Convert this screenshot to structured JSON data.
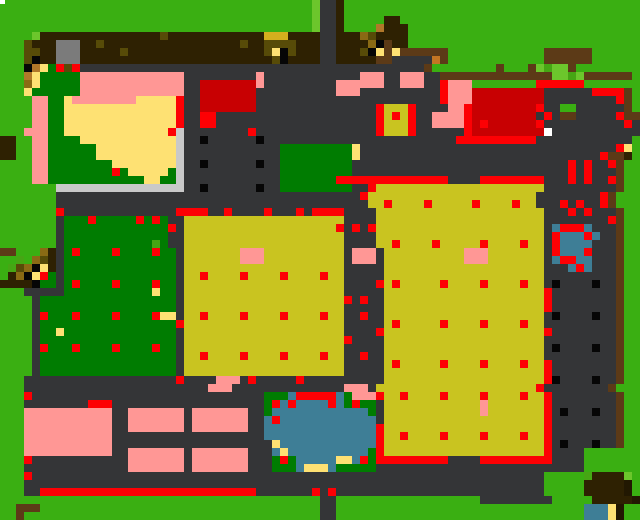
{
  "map": {
    "type": "pixel-tile-map",
    "subject": "top-down pixel farm map",
    "width_px": 640,
    "height_px": 520,
    "tile_size": 8,
    "columns": 80,
    "rows": 65,
    "palette": {
      "G": "#3aaf12",
      "L": "#6cc62c",
      "M": "#46a614",
      "T": "#007c01",
      "Y": "#c9c420",
      "O": "#d4af1e",
      "y": "#fee173",
      "P": "#ff9795",
      "R": "#fd0004",
      "D": "#c80002",
      "N": "#2e2102",
      "S": "#5c3a17",
      "o": "#8a6a14",
      "d": "#574b08",
      "K": "#060606",
      "A": "#343537",
      "l": "#c9c9c9",
      "g": "#7b7b7b",
      "t": "#3e7e96",
      "n": "#b1782a",
      "x": "#c37523",
      "w": "#ffffff",
      "B": "#221802"
    },
    "palette_legend": {
      "G": "grass",
      "L": "light-grass",
      "M": "shrub-green",
      "T": "dark-green-field",
      "Y": "yellow-crop-field",
      "O": "gold-block",
      "y": "pale-yellow-path",
      "P": "pink-building",
      "R": "red-marker",
      "D": "dark-red-building",
      "N": "dark-brown-soil",
      "S": "wood-brown",
      "o": "light-wood",
      "d": "dark-olive-wood",
      "K": "black-dot",
      "A": "dark-path",
      "l": "light-stone",
      "g": "gray-stone",
      "t": "water",
      "n": "tan-wood",
      "x": "orange-block",
      "w": "white-tile",
      "B": "dark-corner"
    },
    "pixel_rows": [
      "GGGGGGGGGGGGGGGGGGGGGGGGGGGGGGGGGGGGGGGLAANGGGGGGGGGGGGGGGGGGGGGGGGGGGGGGGGGGGG",
      "GGGGGGGGGGGGGGGGGGGGGGGGGGGGGGGGGGGGGGGLAANGGGGGGGGGGGGGGGGGGGGGGGGGGGGGGGGGGGG",
      "GGGGGGGGGGGGGGGGGGGGGGGGGGGGGGGGGGGGGGGLAANGGGGGNNGGGGGGGGGGGGGGGGGGGGGGGGGGGGGG",
      "GGGGGGGGGGGGGGGGGGGGGGGGGGGGGGGGGGGGGGGLAANGGGGnNNNGGGGGGGGGGGGGGGGGGGGGGGGGGGGG",
      "GGGGLNNNNNNNNNNNNNNNdNNNNNNNNNNNNOOONNNNAANNNodNNNNGGGGGGGGGGGGGGGGGGGGGGGGGGGGG",
      "GGGdNNNgggNNdNNNNNNNNNNNNNNNNNdNNddddNNNAANNNNoKSNNGGGGGGGGGGGGGGGGGGGGGGGGGGGGG",
      "GGGddNNgggNNNNNdNNNNNNNNNNNNNNNNNdyKdNNNAANNNdKySySSSSSSGGGGGGGGGGGGSSSSSSGGGGGG",
      "GGGdKNNgggNNNNNNNNNNNNNNNNNNNNNNNNdKNNNNAANNNNNSSAAAAAxSGGGGGGGGGGGGSSSSSSGGGGGG",
      "GGGKnyTRdRAAAAAAAAAAAAAAAAAAAAAAAAAAAAAAAAAAAAAAAAAAASGGGGGGGGSGGGSLMLLSGGGGGG",
      "GGGnyTTTTTPPPPPPPPPPPPPAAAAAAAAAPAAAAAAAAAAAAPPPAAPPPAASSSSSSSSSSSSSSLLMLSSSSSSG",
      "GGGoyTTTTTPPPPPPPPPPPPPAADDDDDDDPAAAAAAAAAPPPPPPAAPPPAARPPPGGGGGGGGRRRRRRGGGGGGG",
      "GGGyTTTTTTPPPPPPPPPPPPPAADDDDDDDAAAAAAAAAAPPPAAAAAAAAAARPPPDDDDDDDDDAAAAAARRRRSG",
      "GGGGPPTTyPPPPPPPPyyyyyRAADDDDDDDAAAAAAAAAAAAAAAAAAAAAAARPPPDDDDDDDDDAAAAAAAAARSG",
      "GGGGPPTTyyyyyyyyyyyyyyRAADDDDDDDAAAAAAAAAAAAAAARYYYRAAAAPPRDDDDDDDDRAAGGAAAAAASG",
      "GGGGPPTTyyyyyyyyyyyyyyRAARRAAAAAAAAAAAAAAAAAAAARYRYRAAPPPPRDDDDDDDDARASSAAAAARSS",
      "GGGGPPTTyyyyyyyyyyyyyyRAARRAAAAAAAAAAAAAAAAAAAARYYYRAAPPPPRDRDDDDDDRAAAAAAAAAARA",
      "GGGPPPTTyyyyyyyyyyyyyRlAAAAAAAARAAAAAAAAAAAAAAARYYYRAAAAAARDDDDDDDDDwAAAAAAAAAAA",
      "NNGGPPTTTTyyyyyyyyyyyylAAKAAAAAAKAAAAAAAAAAAAAAAAAAAAAAAARRRRRRRRRRAAAAAAAAAAAA",
      "NNGGPPTTTTTTyyyyyyyyyylAAAAAAAAAAAATTTTTTTTTyAAAAAAAAAAAAAAAAAAAAAAAAAAAAAAAARy",
      "NNGGPPTTTTTTyyyyyyyyyylAAAAAAAAAAAATTTTTTTTTyAAAAAAAAAAAAAAAAAAAAAAAAAAAAAARSSN",
      "GGGGPPTTTTTTTTyyyyyyyylAAKAAAAAAKAATTTTTTTTTAAAAAAAAAAAAAAAAAAAAAAAAAAARARAARSGG",
      "GGGGPPTTTTTTTTRTyyyyyTlAAAAAAAAAAAATTTTTTTTTAAAAAAAAAAAAAAAAAAAAAAAAAAARARAAASGG",
      "GGGGPPTTTTTTTTTTTTyyTTlAAAAAAAAAAAATTTTTTTRRRRRRRRRRRRRRAAAARRRRRRRRAAARARAARSGG",
      "GGGGGGGllllllllllllllllAAKAAAAAAKAATTTTTTTTTAARYYYYYYYYYYYYYYYYYYYYYAAAAAAAAASGG",
      "GGGGGGGAAAAAAAAAAAAAAAAAAAAAAAAAAAAAAAAAAAAAARYYYYYYYYYYYYYYYYYYYYYAAAAAAAARSGG",
      "GGGGGGGAAAAAAAAAAAAAAAAAAAAAAAAAAAAAAAAAAAAAAAYYRYYYYRYYYYYRYYYYRYYAAARARAARSGG",
      "GGGGGGGRAAAAAAAAAAAAAARRRRAARAAAARAAARARRRRAAAAYYYYYYYYYYYYYYYYYYYYYAAARARAAASGG",
      "GGGGGGGATTTRTTTTTRTRTAAYYYYYYYYYYYYYYYYYYYYAAAAYYYYYYYYYYYYYYYYYYYYYAAAAAAAARSGG",
      "GGGGGGGATTTTTTTTTTTTTRAYYYYYYYYYYYYYYYYYYYRARARYYYYYYYYYYYYYYYYYYYYYAtRRRtAAASGG",
      "GGGGGGGATTTTTTTTTTTTTAAYYYYYYYYYYYYYYYYYYYYAAAAYYYYYYYYYYYYYYYYYYYYYARtttRtAASGG",
      "GGGGGGGATTTTTTTTTTTMTAAYYYYYYYYYYYYYYYYYYYYAAAAYYRYYYYRYYYYYRYYYYRYYARttttAAASGG",
      "SSGGGoNATRTTTTRTTTTRTTAYYYYYYYPPPYYYYYYYYYYAPPPAYYYYYYYYYYPPPYYYYYYYARtttRAAASGG",
      "GGMGodNATTTTTTTTTTTTTTAYYYYYYYPPPYYYYYYYYYYAPPPAYYYYYYYYYYPPPYYYYYYYAtRRttAAASGG",
      "GMdoKyNATTTTTTTTTTTTTTAYYYYYYYYYYYYYYYYYYYYAAAAAYYYYYYYYYYYYYYYYYYYYAAAtRtAAASGG",
      "GNoKyRTATTTTTTTTTTTTTTAYYRYYYYRYYYYRYYYYRYYAAAAAYYYYYYYYYYYYYYYYYYYYAAAAAAAAASGG",
      "NNNNKTTATRTTTTRTTTTRTTAYYYYYYYYYYYYYYYYYYYYAAAARYRYYYYYRYYYYRYYYYRYYAKAAAAKAASGG",
      "GGGAAAAATTTTTTTTTTTyTTAYYYYYYYYYYYYYYYYYYYYAAAAAYYYYYYYYYYYYYYYYYYYYRAAAAAAAASGG",
      "GGGGATTTTTTTTTTTTTTTTTAYYYYYYYYYYYYYYYYYYYYRARAAYYYYYYYYYYYYYYYYYYYYRAAAAAAAASGG",
      "GGGGATTTTTTTTTTTTTTTTTAYYYYYYYYYYYYYYYYYYYYAAAAAYYYYYYYYYYYYYYYYYYYYRAAAAAAAASGG",
      "GGGGARTTTRTTTTRTTTTRyyAYYRYYYYRYYYYRYYYYRYYAARAAYYYYYYYYYYYYYYYYYYYYAKAAAAKAASGG",
      "GGGGATTTTTTTTTTTTTTTTTRYYYYYYYYYYYYYYYYYYYYAAAAAYRYYYYYRYYYYRYYYYRYYAAAAAAAAASGG",
      "GGGGATTyTTTTTTTTTTTTTTAYYYYYYYYYYYYYYYYYYYYAAAARYYYYYYYYYYYYYYYYYYYYRAAAAAAAASGG",
      "GGGGATTTTTTTTTTTTTTTTTAYYYYYYYYYYYYYYYYYYYYRAAAAYYYYYYYYYYYYYYYYYYYYAAAAAAAAASGG",
      "GGGGARTTTRTTTTRTTTTRTTAYYYYYYYYYYYYYYYYYYYYAAAAAYYYYYYYYYYYYYYYYYYYYAKAAAAKAASGG",
      "GGGGATTTTTTTTTTTTTTTTTAYYRYYYYRYYYYRYYYYRYYAARAAYYYYYYYYYYYYYYYYYYYYAAAAAAAAASGG",
      "GGGGATTTTTTTTTTTTTTTTTAYYYYYYYYYYYYYYYYYYYYAAAAAYRYYYYYRYYYYRYYYYRYYRAAAAAAAASGG",
      "GGGGATTTTTTTTTTTTTTTTTAYYYYYYYYYYYYYYYYYYYYAAAAAYYYYYYYYYYYYYYYYYYYYRAAAAAAAASGG",
      "GGGAAAAAAAAAAAAAAAAAAARAAAAPPPARAAAAARAAAAAAAAAAYYYYYYYYYYYYYYYYYYYYRKAAAAKAASGG",
      "GGGAAAAAAAAAAAAAAAAAAAAAAAPPPAAAAAAAAAAAAAAPPPAYYYYYYYYYYYYYYYYYYYYRAAAAAAAASGG",
      "GGGRAAAAAAAAAAAAAAAAAAAAAAAAAAAAATTTtRRRRRtTPPPRYYRYYYYRYYYYRYYYYRYYRAAAAAAAASGG",
      "GGGAAAAAAAARRRAAAAAAAAAAAAAAAAAAATRtRttttRtTRTTAYYYYYYYYYYYYPYYYYYYYRAAAAAAAASGG",
      "GGGPPPPPPPPPPPAAPPPPPPPAPPPPPPPAATttttttttttttTAYYYYYYYYYYYYPYYYYYYYRAKAAAKAASGG",
      "GGGPPPPPPPPPPPAAPPPPPPPAPPPPPPPAAtRttttttttttttAYYYYYYYYYYYYYYYYYYYYRAAAAAAAASGG",
      "GGGPPPPPPPPPPPAAPPPPPPPAPPPPPPPAAttttttttttttttRYYYYYYYYYYYYYYYYYYYYRAAAAAAAASGG",
      "GGGPPPPPPPPPPPAAAAAAAAAAAAAAAAAAAttttttttttttttRYYRYYYYRYYYYRYYYYRYYRAAAAAAAASGG",
      "GGGPPPPPPPPPPPAAAAAAAAAAAAAAAAAAAAyttttttttttttRYYYYYYYYYYYYYYYYYYYYRAKAAAKAASGG",
      "GGGPPPPPPPPPPPAAPPPPPPPAPPPPPPPAAAtyttttttttttTRYYYYYYYYYYYYYYYYYYYYRAAAAGGGGGGG",
      "GGGRAAAAAAAAAAAAPPPPPPPAPPPPPPPAAATRTtttttyytRTRRRRRRRRRAAAARRRRRRRRRAAAAGGGGGGG",
      "GGGAAAAAAAAAAAAAPPPPPPPAPPPPPPPAAATTTtyyytTTTTTAAAAAAAAAAAAAAAAAAAAAAAAAAGGGGGGG",
      "GGGRAAAAAAAAAAAAAAAAAAAAAAAAAAAAAAAAAAAAAAAAAAAAAAAAAAAAAAAAAAAAAAAAGGGGGMNNNNL",
      "GGGAAAAAAAAAAAAAAAAAAAAAAAAAAAAAAAAAAAAAAAAAAAAAAAAAAAAAAAAAAAAAAAAAGGGGGNNNNNB",
      "GGGAARRRRRRRRRRRRRRRRRRRRRRRRRRRAAAAAAARARAAAAAAAAAAAAAAAAAAAAAAAAAAGGGGGNNNNNB",
      "GGGGGGGGGGGGGGGGGGGGGGGGGGGGGGGGGGGGGGGGAAGGGGGGGGGGGGGGGGGGAAAAAAAAAGGGGGNNNNNB",
      "GGSSSGGGGGGGGGGGGGGGGGGGGGGGGGGGGGGGGGGGAAGGGGGGGGGGGGGGGGGGGGGGGGGGGGGGGtttyB",
      "GGSGGGGGGGGGGGGGGGGGGGGGGGGGGGGGGGGGGGGGAAGGGGGGGGGGGGGGGGGGGGGGGGGGGGGGGtttyB"
    ],
    "overlays": [
      {
        "name": "white-speck",
        "x": 0,
        "y": 0,
        "w": 5,
        "h": 4,
        "color": "#ffffff"
      }
    ]
  }
}
